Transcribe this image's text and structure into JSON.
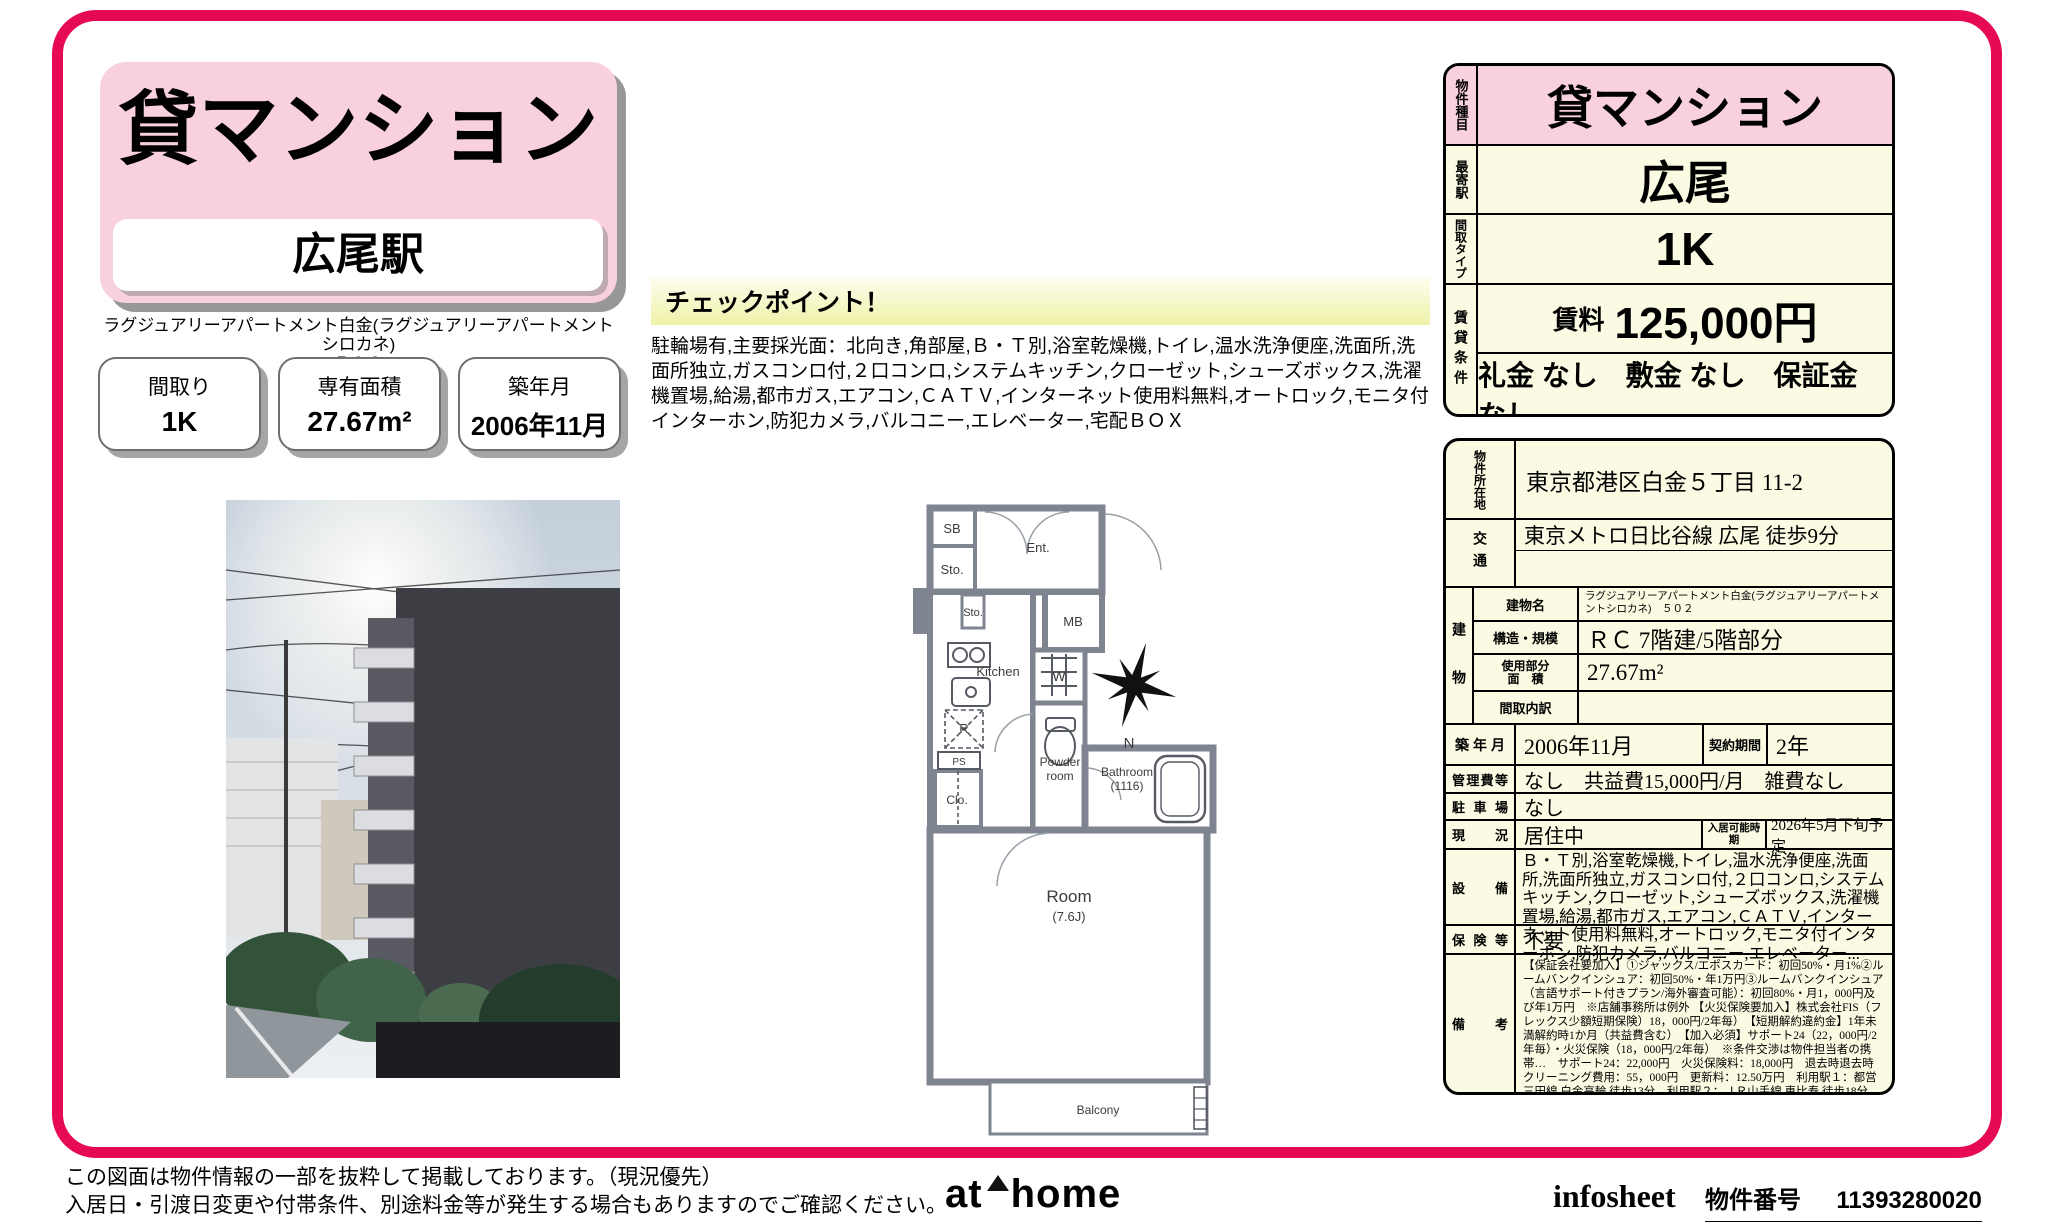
{
  "header": {
    "property_type": "貸マンション",
    "station": "広尾駅",
    "property_name": "ラグジュアリーアパートメント白金(ラグジュアリーアパートメントシロカネ)",
    "property_unit": "５０２",
    "badges": [
      {
        "label": "間取り",
        "value": "1K"
      },
      {
        "label": "専有面積",
        "value": "27.67m²"
      },
      {
        "label": "築年月",
        "value": "2006年11月"
      }
    ]
  },
  "checkpoint": {
    "title": "チェックポイント！",
    "body": "駐輪場有,主要採光面：北向き,角部屋,Ｂ・Ｔ別,浴室乾燥機,トイレ,温水洗浄便座,洗面所,洗面所独立,ガスコンロ付,２口コンロ,システムキッチン,クローゼット,シューズボックス,洗濯機置場,給湯,都市ガス,エアコン,ＣＡＴＶ,インターネット使用料無料,オートロック,モニタ付インターホン,防犯カメラ,バルコニー,エレベーター,宅配ＢＯＸ"
  },
  "summary_table": {
    "type_label": "物件種目",
    "type_value": "貸マンション",
    "station_label": "最寄駅",
    "station_value": "広尾",
    "layout_label": "間取タイプ",
    "layout_value": "1K",
    "terms_label": "賃貸条件",
    "rent_label": "賃料",
    "rent_value": "125,000円",
    "terms_value": "礼金 なし　敷金 なし　保証金 なし"
  },
  "detail_table": {
    "location_label": "物件所在地",
    "location_value": "東京都港区白金５丁目 11-2",
    "access_label": "交通",
    "access_value": "東京メトロ日比谷線 広尾 徒歩9分",
    "building_label": "建物",
    "building_name_label": "建物名",
    "building_name_value": "ラグジュアリーアパートメント白金(ラグジュアリーアパートメントシロカネ)　５０２",
    "structure_label": "構造・規模",
    "structure_value": "ＲＣ 7階建/5階部分",
    "area_label_line1": "使用部分",
    "area_label_line2": "面　積",
    "area_value": "27.67m²",
    "layout_detail_label": "間取内訳",
    "layout_detail_value": "",
    "built_label": "築年月",
    "built_value": "2006年11月",
    "contract_label": "契約期間",
    "contract_value": "2年",
    "mgmt_label": "管理費等",
    "mgmt_value": "なし　共益費15,000円/月　雑費なし",
    "parking_label": "駐車場",
    "parking_value": "なし",
    "status_label": "現　況",
    "status_value": "居住中",
    "movein_label": "入居可能時期",
    "movein_value": "2026年5月下旬予定",
    "equipment_label": "設　備",
    "equipment_value": "Ｂ・Ｔ別,浴室乾燥機,トイレ,温水洗浄便座,洗面所,洗面所独立,ガスコンロ付,２口コンロ,システムキッチン,クローゼット,シューズボックス,洗濯機置場,給湯,都市ガス,エアコン,ＣＡＴＶ,インターネット使用料無料,オートロック,モニタ付インターホン,防犯カメラ,バルコニー,エレベーター...",
    "insurance_label": "保険等",
    "insurance_value": "不要",
    "remarks_label": "備　考",
    "remarks_value": "【保証会社要加入】①ジャックス/エポスカード：初回50%・月1%②ルームバンクインシュア：初回50%・年1万円③ルームバンクインシュア（言語サポート付きプラン/海外審査可能）：初回80%・月1，000円及び年1万円　※店舗事務所は例外 【火災保険要加入】株式会社FIS（フレックス少額短期保険）18，000円/2年毎）　【短期解約違約金】1年未満解約時1か月（共益費含む）　【加入必須】サポート24（22，000円/2年毎）・火災保険（18，000円/2年毎）　※条件交渉は物件担当者の携帯…　サポート24：22,000円　火災保険料：18,000円　退去時退去時クリーニング費用：55，000円　更新料：12.50万円　利用駅１：都営三田線 白金高輪 徒歩13分　利用駅２：ＪＲ山手線 恵比寿 徒歩18分"
  },
  "floorplan": {
    "sb": "SB",
    "sto1": "Sto.",
    "ent": "Ent.",
    "sto2": "Sto.",
    "mb": "MB",
    "kitchen": "Kitchen",
    "w": "W",
    "r": "R",
    "ps": "PS",
    "clo": "Clo.",
    "powder_line1": "Powder",
    "powder_line2": "room",
    "bath_line1": "Bathroom",
    "bath_line2": "(1116)",
    "room_line1": "Room",
    "room_line2": "(7.6J)",
    "balcony": "Balcony",
    "north": "N"
  },
  "footer": {
    "disclaimer_line1": "この図面は物件情報の一部を抜粋して掲載しております。（現況優先）",
    "disclaimer_line2": "入居日・引渡日変更や付帯条件、別途料金等が発生する場合もありますのでご確認ください。",
    "logo_at": "at",
    "logo_home": "home",
    "infosheet": "infosheet",
    "property_number_label": "物件番号",
    "property_number": "11393280020"
  },
  "colors": {
    "frame_red": "#e60a52",
    "pink": "#f9d0de",
    "cream": "#fbfae2",
    "checkpoint_yellow": "#eef2a8"
  }
}
